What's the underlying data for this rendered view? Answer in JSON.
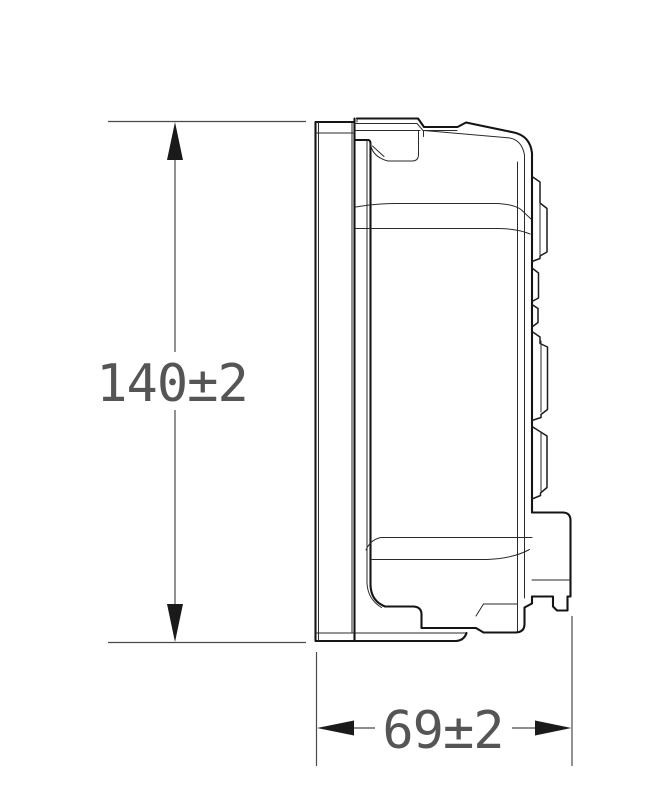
{
  "drawing": {
    "view": "side-view-outline-drawing",
    "background_color": "#ffffff",
    "line_color": "#141414",
    "dimension_color": "#4a4a4a",
    "dimensions": {
      "height": {
        "label": "140±2",
        "value": 140,
        "tolerance": "±2",
        "orientation": "vertical"
      },
      "depth": {
        "label": "69±2",
        "value": 69,
        "tolerance": "±2",
        "orientation": "horizontal"
      }
    }
  }
}
